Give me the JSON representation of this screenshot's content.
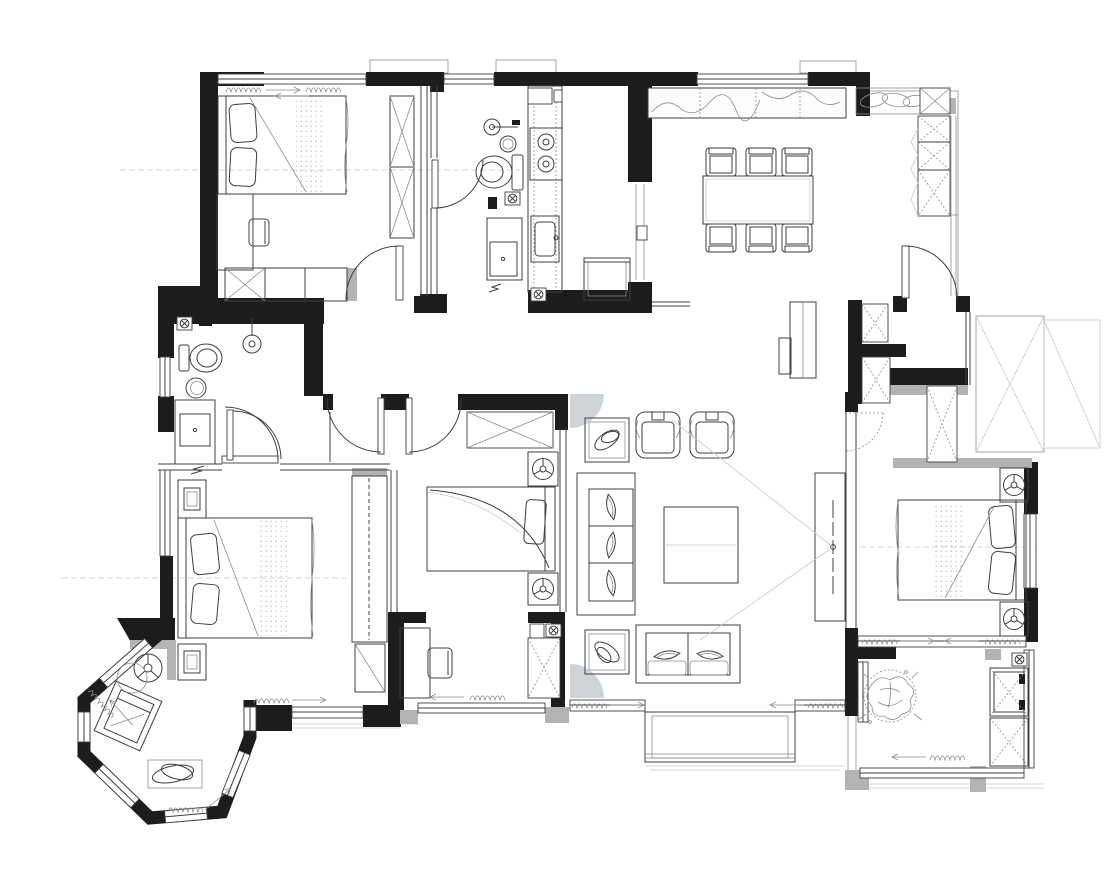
{
  "meta": {
    "title": "apartment-floor-plan",
    "drawing_type": "architectural plan, black-and-white CAD linework, no text labels",
    "canvas": {
      "width": 1112,
      "height": 882
    }
  },
  "colors": {
    "wall": "#1c1c1c",
    "wallGray": "#b3b3b3",
    "line": "#3f3f3f",
    "lineLight": "#8d8d8d",
    "lineFaint": "#c9c9c9",
    "cornerGray": "#c9cdd0",
    "marble": "#fcfcfc",
    "background": "#ffffff"
  },
  "rooms": [
    {
      "id": "bedroom-top-left",
      "furniture": [
        "double-bed",
        "pillows-2",
        "desk",
        "desk-chair",
        "wardrobe-hatched",
        "tall-cabinet-x",
        "window-top",
        "door-arc"
      ]
    },
    {
      "id": "bathroom-top",
      "furniture": [
        "shower-head",
        "toilet",
        "round-basin",
        "floor-drain",
        "vanity-sink",
        "door-arc"
      ]
    },
    {
      "id": "kitchen",
      "furniture": [
        "counter-run",
        "cooktop-2-burners",
        "kitchen-sink",
        "refrigerator",
        "floor-drain",
        "sliding-door"
      ]
    },
    {
      "id": "dining-room",
      "furniture": [
        "dining-table",
        "dining-chairs-6",
        "marble-counter",
        "drapery-valance",
        "tall-cabinet-x",
        "sideboard",
        "entry-door-arc"
      ]
    },
    {
      "id": "entry-hall",
      "furniture": [
        "shoe-cabinet-x-2",
        "hidden-door-dashed",
        "service-shaft-x"
      ]
    },
    {
      "id": "bathroom-left",
      "furniture": [
        "toilet",
        "shower-head",
        "round-basin",
        "vanity-sink",
        "floor-drain",
        "door-arcs-2"
      ]
    },
    {
      "id": "hallway",
      "furniture": [
        "double-door-arcs",
        "storage-closet-x"
      ]
    },
    {
      "id": "bedroom-left",
      "furniture": [
        "double-bed",
        "pillows-2",
        "nightstand-2",
        "wardrobe-hatched",
        "mirror-cabinet"
      ]
    },
    {
      "id": "bay-window-lounge",
      "furniture": [
        "lounge-chair",
        "floor-lamp",
        "side-table",
        "rug-oval",
        "octagonal-bay-windows"
      ]
    },
    {
      "id": "bedroom-center",
      "furniture": [
        "bed",
        "pillow",
        "nightstand-lamp-2",
        "closet-x",
        "desk",
        "desk-chair",
        "duct-shaft-x",
        "floor-drain"
      ]
    },
    {
      "id": "living-room",
      "furniture": [
        "sofa-3-seat",
        "sofa-2-seat",
        "armchair-2",
        "coffee-table",
        "side-table-2",
        "tv-cabinet",
        "sight-lines",
        "corner-curves"
      ]
    },
    {
      "id": "master-bedroom",
      "furniture": [
        "double-bed",
        "pillows-2",
        "nightstand-lamp-2",
        "closet-x",
        "window-wall"
      ]
    },
    {
      "id": "balcony",
      "furniture": [
        "plant",
        "washing-machine",
        "storage-cabinet-x",
        "floor-drain",
        "window-wall"
      ]
    }
  ],
  "symbols": [
    "curtain-coil",
    "direction-arrow",
    "floor-drain-x",
    "lamp-circle",
    "burner-circle",
    "center-axis-dashed"
  ]
}
